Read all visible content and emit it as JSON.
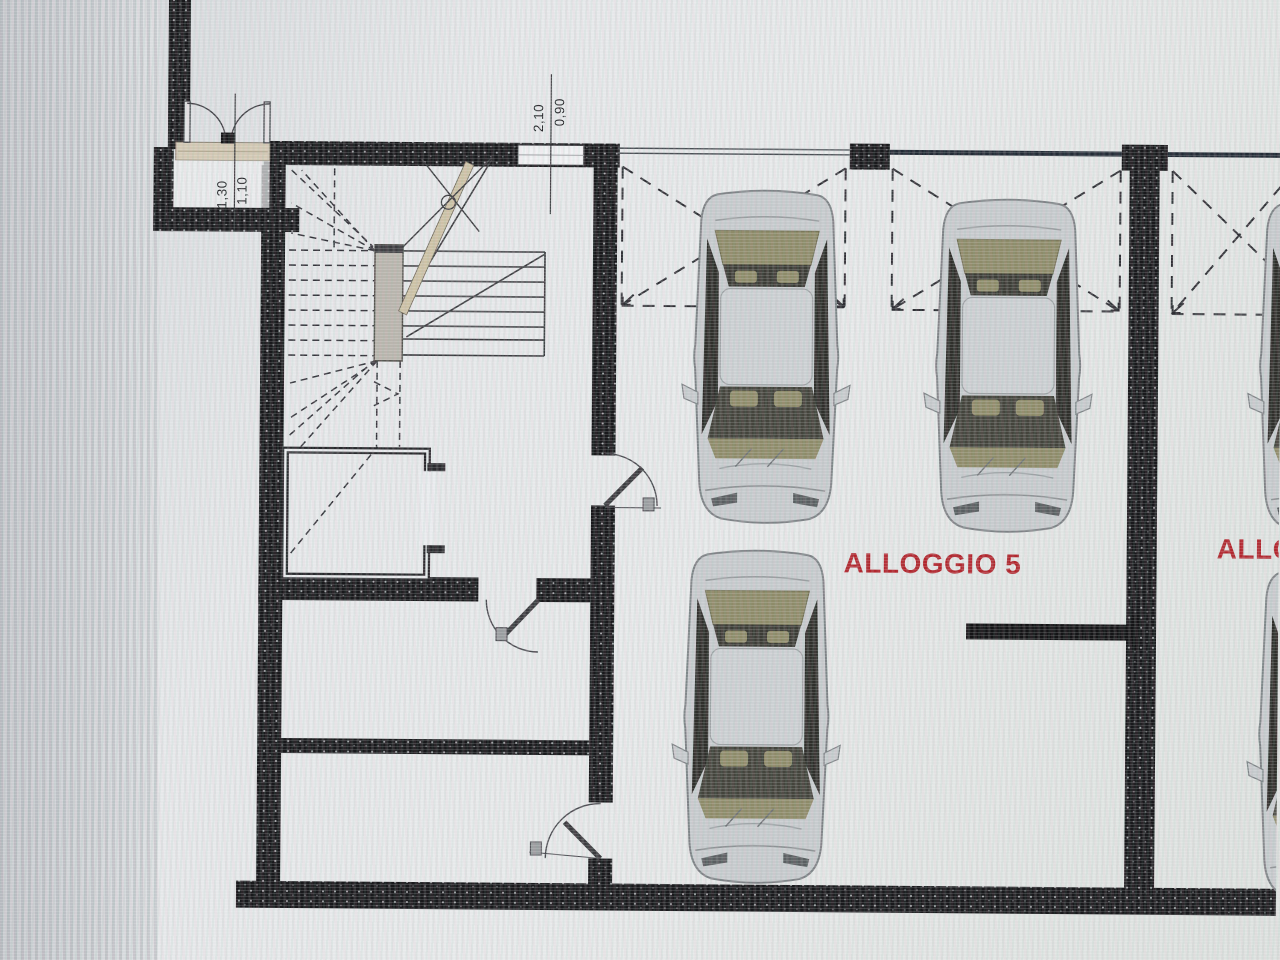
{
  "title": "Basement garage floor plan (photographed screen)",
  "labels": {
    "unit5": "ALLOGGIO 5",
    "unit_right_clipped": "ALLO",
    "door_top": {
      "width": "0,90",
      "height": "2,10"
    },
    "entry_door": {
      "width": "1,10",
      "height": "1,30"
    }
  },
  "plan": {
    "visible_label_texts": [
      "ALLOGGIO 5",
      "ALLO",
      "0,90",
      "2,10",
      "1,10",
      "1,30"
    ],
    "car_count_visible": 5,
    "parking_spaces_marked": 3
  },
  "colors": {
    "label_red": "#b2262e",
    "wall_dark": "#19191c",
    "paper_light": "#e7e9ea",
    "cut_band_beige": "#cdc2a6",
    "threshold_beige": "#d3c9b4",
    "car_body": "#c7cbce",
    "car_interior_olive": "#8e8b69",
    "top_beam_line": "#232b36"
  }
}
